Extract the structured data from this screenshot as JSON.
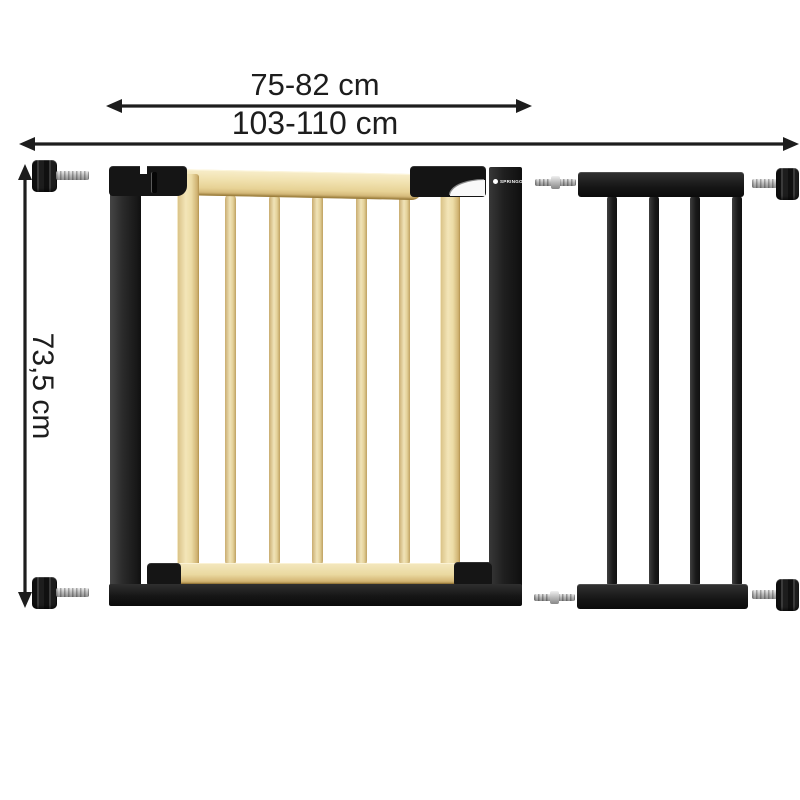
{
  "diagram": {
    "kind": "product-dimension-diagram",
    "product": "Pressure-fit baby safety gate (wood and black metal) with black metal extension panel",
    "background_color": "#ffffff"
  },
  "dimensions": {
    "inner_width_label": "75-82 cm",
    "total_width_label": "103-110 cm",
    "height_label": "73,5 cm"
  },
  "brand": {
    "badge_label": "SPRINGOS"
  },
  "gate": {
    "wooden_bar_count": 5,
    "frame_color": "#151515",
    "wood_color": "#ecd9a4"
  },
  "extension": {
    "bar_count": 4,
    "color": "#161616"
  },
  "hardware": {
    "pressure_knob_count": 4,
    "connector_pin_count": 2,
    "knob_color": "#1c1c1c",
    "shaft_color": "#bdbdbd"
  },
  "annotation": {
    "line_color": "#1d1d1d"
  }
}
